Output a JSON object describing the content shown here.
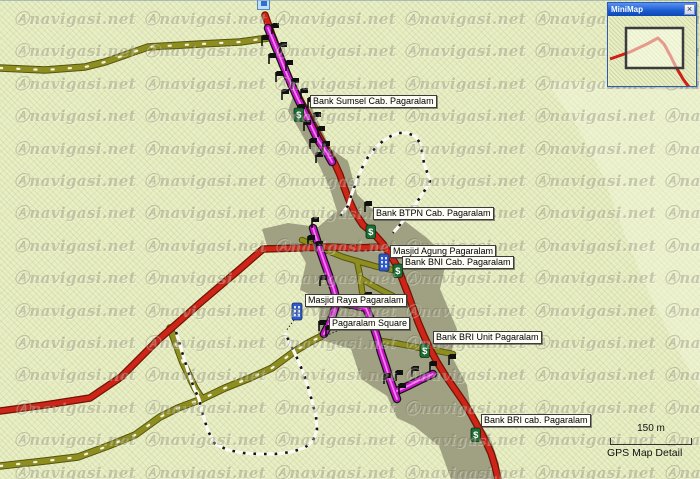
{
  "app": {
    "map_type_label": "GPS Map Detail"
  },
  "watermark": {
    "logo": "Ⓐ",
    "text": "navigasi.net",
    "cols_x": [
      14,
      144,
      274,
      404,
      534,
      664
    ],
    "row_start": 8,
    "row_step": 32.4,
    "row_count": 15
  },
  "minimap": {
    "title": "MiniMap",
    "close_glyph": "×",
    "track": [
      [
        1,
        43
      ],
      [
        21,
        36
      ],
      [
        38,
        28
      ],
      [
        49,
        22
      ],
      [
        55,
        28
      ],
      [
        61,
        39
      ],
      [
        67,
        51
      ],
      [
        74,
        63
      ],
      [
        80,
        71
      ]
    ],
    "viewport": {
      "x": 17,
      "y": 12,
      "w": 57,
      "h": 40
    }
  },
  "scalebar": {
    "distance_label": "150 m"
  },
  "poi_labels": [
    {
      "id": "bank-sumsel",
      "text": "Bank Sumsel Cab. Pagaralam",
      "x": 310,
      "y": 95
    },
    {
      "id": "bank-btpn",
      "text": "Bank BTPN Cab. Pagaralam",
      "x": 373,
      "y": 207
    },
    {
      "id": "masjid-agung",
      "text": "Masjid Agung Pagaralam",
      "x": 390,
      "y": 245
    },
    {
      "id": "bank-bni",
      "text": "Bank BNI Cab. Pagaralam",
      "x": 402,
      "y": 256
    },
    {
      "id": "masjid-raya",
      "text": "Masjid Raya Pagaralam",
      "x": 305,
      "y": 294
    },
    {
      "id": "pagaralam-square",
      "text": "Pagaralam Square",
      "x": 329,
      "y": 317
    },
    {
      "id": "bank-bri-unit",
      "text": "Bank BRI Unit Pagaralam",
      "x": 433,
      "y": 331
    },
    {
      "id": "bank-bri-cab",
      "text": "Bank BRI cab. Pagaralam",
      "x": 481,
      "y": 414
    }
  ],
  "icons": {
    "bank_glyph": "$",
    "bank_positions": [
      [
        294,
        108
      ],
      [
        366,
        225
      ],
      [
        393,
        264
      ],
      [
        420,
        344
      ],
      [
        471,
        428
      ]
    ],
    "mosque_positions": [
      [
        379,
        254
      ],
      [
        292,
        303
      ]
    ],
    "flag_positions": [
      [
        272,
        33
      ],
      [
        262,
        45
      ],
      [
        280,
        52
      ],
      [
        269,
        63
      ],
      [
        286,
        70
      ],
      [
        276,
        81
      ],
      [
        292,
        88
      ],
      [
        282,
        99
      ],
      [
        301,
        98
      ],
      [
        298,
        114
      ],
      [
        308,
        107
      ],
      [
        314,
        122
      ],
      [
        304,
        130
      ],
      [
        318,
        136
      ],
      [
        310,
        148
      ],
      [
        323,
        151
      ],
      [
        316,
        162
      ],
      [
        365,
        211
      ],
      [
        312,
        227
      ],
      [
        308,
        245
      ],
      [
        316,
        251
      ],
      [
        320,
        285
      ],
      [
        365,
        302
      ],
      [
        319,
        330
      ],
      [
        326,
        335
      ],
      [
        384,
        383
      ],
      [
        396,
        380
      ],
      [
        399,
        393
      ],
      [
        412,
        376
      ],
      [
        430,
        371
      ],
      [
        449,
        364
      ]
    ]
  },
  "colors": {
    "bg": "#e9efc5",
    "urban": "#9c9c80",
    "light_area": "#f2f6d9",
    "olive_casing": "#55550e",
    "olive_fill": "#8e8e20",
    "olive_dots": "#f2f2e0",
    "red_casing": "#6f1407",
    "red_fill": "#cf2418",
    "magenta_casing": "#151515",
    "magenta_fill": "#c714c7",
    "magenta_center": "#f27df2",
    "track_white": "#fbfbf2",
    "track_black": "#141414",
    "flag": "#101010",
    "bank_bg": "#1e6b33",
    "bank_border": "#0b2e14",
    "mosque_bg": "#2f59c9",
    "mosque_border": "#14296b",
    "minimap_red": "#cc2018",
    "viewport_stroke": "#3c3c3c"
  },
  "map_geometry": {
    "urban_polygon": [
      [
        293,
        96
      ],
      [
        312,
        108
      ],
      [
        330,
        148
      ],
      [
        348,
        161
      ],
      [
        357,
        194
      ],
      [
        371,
        208
      ],
      [
        406,
        222
      ],
      [
        427,
        238
      ],
      [
        447,
        258
      ],
      [
        440,
        289
      ],
      [
        457,
        329
      ],
      [
        451,
        355
      ],
      [
        467,
        385
      ],
      [
        471,
        410
      ],
      [
        491,
        440
      ],
      [
        499,
        464
      ],
      [
        497,
        479
      ],
      [
        451,
        479
      ],
      [
        439,
        446
      ],
      [
        414,
        426
      ],
      [
        397,
        418
      ],
      [
        387,
        396
      ],
      [
        361,
        379
      ],
      [
        351,
        349
      ],
      [
        318,
        339
      ],
      [
        320,
        299
      ],
      [
        300,
        290
      ],
      [
        306,
        263
      ],
      [
        296,
        245
      ],
      [
        268,
        249
      ],
      [
        262,
        229
      ],
      [
        288,
        223
      ],
      [
        318,
        227
      ],
      [
        337,
        211
      ],
      [
        329,
        186
      ],
      [
        317,
        161
      ],
      [
        300,
        131
      ],
      [
        288,
        111
      ]
    ],
    "light_polygon": [
      [
        547,
        82
      ],
      [
        578,
        128
      ],
      [
        604,
        178
      ],
      [
        624,
        233
      ],
      [
        649,
        293
      ],
      [
        674,
        343
      ],
      [
        700,
        389
      ],
      [
        700,
        80
      ]
    ],
    "roads": [
      {
        "id": "olive-topleft",
        "type": "olive-dotted",
        "pts": [
          [
            0,
            68
          ],
          [
            45,
            70
          ],
          [
            85,
            67
          ],
          [
            105,
            62
          ],
          [
            148,
            47
          ],
          [
            200,
            44
          ],
          [
            240,
            42
          ],
          [
            268,
            38
          ]
        ]
      },
      {
        "id": "olive-north-spur",
        "type": "olive-dotted",
        "pts": [
          [
            170,
            328
          ],
          [
            183,
            363
          ],
          [
            195,
            388
          ],
          [
            202,
            399
          ]
        ]
      },
      {
        "id": "olive-southwest",
        "type": "olive-dotted",
        "pts": [
          [
            0,
            466
          ],
          [
            45,
            461
          ],
          [
            78,
            457
          ],
          [
            108,
            446
          ],
          [
            135,
            435
          ],
          [
            160,
            417
          ],
          [
            178,
            408
          ],
          [
            202,
            399
          ],
          [
            225,
            388
          ],
          [
            250,
            378
          ],
          [
            272,
            368
          ],
          [
            295,
            351
          ],
          [
            310,
            342
          ],
          [
            322,
            336
          ]
        ]
      },
      {
        "id": "olive-city-1",
        "type": "olive",
        "pts": [
          [
            302,
            240
          ],
          [
            318,
            247
          ],
          [
            343,
            257
          ],
          [
            360,
            262
          ],
          [
            378,
            267
          ],
          [
            393,
            270
          ]
        ]
      },
      {
        "id": "olive-city-2",
        "type": "olive",
        "pts": [
          [
            357,
            261
          ],
          [
            360,
            276
          ],
          [
            362,
            291
          ],
          [
            366,
            306
          ]
        ]
      },
      {
        "id": "olive-city-3",
        "type": "olive",
        "pts": [
          [
            360,
            278
          ],
          [
            372,
            285
          ],
          [
            383,
            291
          ],
          [
            393,
            296
          ]
        ]
      },
      {
        "id": "olive-city-4",
        "type": "olive",
        "pts": [
          [
            381,
            341
          ],
          [
            400,
            344
          ],
          [
            420,
            348
          ],
          [
            438,
            351
          ],
          [
            453,
            354
          ]
        ]
      },
      {
        "id": "red-main",
        "type": "red",
        "pts": [
          [
            265,
            15
          ],
          [
            272,
            35
          ],
          [
            281,
            58
          ],
          [
            291,
            83
          ],
          [
            299,
            98
          ],
          [
            306,
            111
          ],
          [
            313,
            125
          ],
          [
            321,
            140
          ],
          [
            329,
            153
          ],
          [
            335,
            164
          ],
          [
            340,
            175
          ],
          [
            344,
            187
          ],
          [
            349,
            200
          ],
          [
            355,
            213
          ],
          [
            363,
            225
          ],
          [
            374,
            234
          ],
          [
            383,
            244
          ],
          [
            391,
            256
          ],
          [
            398,
            268
          ],
          [
            403,
            281
          ],
          [
            408,
            294
          ],
          [
            413,
            308
          ],
          [
            418,
            322
          ],
          [
            424,
            336
          ],
          [
            430,
            349
          ],
          [
            437,
            362
          ],
          [
            445,
            375
          ],
          [
            454,
            388
          ],
          [
            463,
            401
          ],
          [
            471,
            414
          ],
          [
            478,
            427
          ],
          [
            485,
            440
          ],
          [
            491,
            453
          ],
          [
            495,
            466
          ],
          [
            498,
            479
          ]
        ]
      },
      {
        "id": "red-west-branch",
        "type": "red",
        "pts": [
          [
            0,
            411
          ],
          [
            45,
            405
          ],
          [
            90,
            398
          ],
          [
            121,
            377
          ],
          [
            157,
            341
          ],
          [
            200,
            303
          ],
          [
            240,
            269
          ],
          [
            263,
            249
          ],
          [
            300,
            248
          ],
          [
            330,
            247
          ],
          [
            355,
            248
          ],
          [
            383,
            247
          ]
        ]
      },
      {
        "id": "magenta-north",
        "type": "magenta",
        "pts": [
          [
            268,
            28
          ],
          [
            277,
            50
          ],
          [
            288,
            77
          ],
          [
            298,
            99
          ],
          [
            308,
            119
          ],
          [
            318,
            140
          ],
          [
            327,
            153
          ],
          [
            332,
            162
          ]
        ]
      },
      {
        "id": "magenta-city-a",
        "type": "magenta",
        "pts": [
          [
            313,
            228
          ],
          [
            320,
            250
          ],
          [
            327,
            270
          ],
          [
            334,
            290
          ],
          [
            337,
            302
          ],
          [
            331,
            320
          ],
          [
            324,
            334
          ]
        ]
      },
      {
        "id": "magenta-city-cross",
        "type": "magenta",
        "pts": [
          [
            337,
            302
          ],
          [
            352,
            305
          ],
          [
            366,
            308
          ]
        ]
      },
      {
        "id": "magenta-city-b",
        "type": "magenta",
        "pts": [
          [
            366,
            308
          ],
          [
            372,
            322
          ],
          [
            377,
            337
          ],
          [
            381,
            352
          ],
          [
            386,
            367
          ],
          [
            390,
            380
          ],
          [
            394,
            391
          ],
          [
            397,
            399
          ]
        ]
      },
      {
        "id": "magenta-city-spur",
        "type": "magenta",
        "pts": [
          [
            397,
            391
          ],
          [
            410,
            385
          ],
          [
            422,
            379
          ],
          [
            433,
            374
          ]
        ]
      }
    ],
    "tracks": [
      {
        "id": "track-north-loop",
        "pts": [
          [
            340,
            216
          ],
          [
            348,
            206
          ],
          [
            352,
            193
          ],
          [
            357,
            180
          ],
          [
            362,
            168
          ],
          [
            368,
            157
          ],
          [
            375,
            148
          ],
          [
            383,
            141
          ],
          [
            391,
            136
          ],
          [
            399,
            133
          ],
          [
            407,
            133
          ],
          [
            415,
            136
          ],
          [
            420,
            143
          ],
          [
            422,
            152
          ],
          [
            424,
            163
          ],
          [
            427,
            172
          ],
          [
            430,
            181
          ],
          [
            425,
            190
          ],
          [
            419,
            199
          ],
          [
            413,
            208
          ],
          [
            406,
            217
          ],
          [
            399,
            226
          ],
          [
            393,
            233
          ]
        ]
      },
      {
        "id": "track-south-loop",
        "pts": [
          [
            176,
            332
          ],
          [
            182,
            352
          ],
          [
            188,
            371
          ],
          [
            194,
            388
          ],
          [
            199,
            399
          ],
          [
            203,
            415
          ],
          [
            208,
            431
          ],
          [
            215,
            444
          ],
          [
            228,
            450
          ],
          [
            243,
            453
          ],
          [
            259,
            454
          ],
          [
            275,
            454
          ],
          [
            291,
            452
          ],
          [
            304,
            448
          ],
          [
            313,
            441
          ],
          [
            317,
            430
          ],
          [
            316,
            416
          ],
          [
            312,
            401
          ],
          [
            308,
            387
          ],
          [
            303,
            372
          ],
          [
            297,
            358
          ],
          [
            291,
            345
          ],
          [
            285,
            333
          ]
        ]
      }
    ],
    "leaders": [
      [
        [
          337,
          331
        ],
        [
          325,
          336
        ]
      ],
      [
        [
          294,
          320
        ],
        [
          286,
          331
        ]
      ]
    ]
  }
}
